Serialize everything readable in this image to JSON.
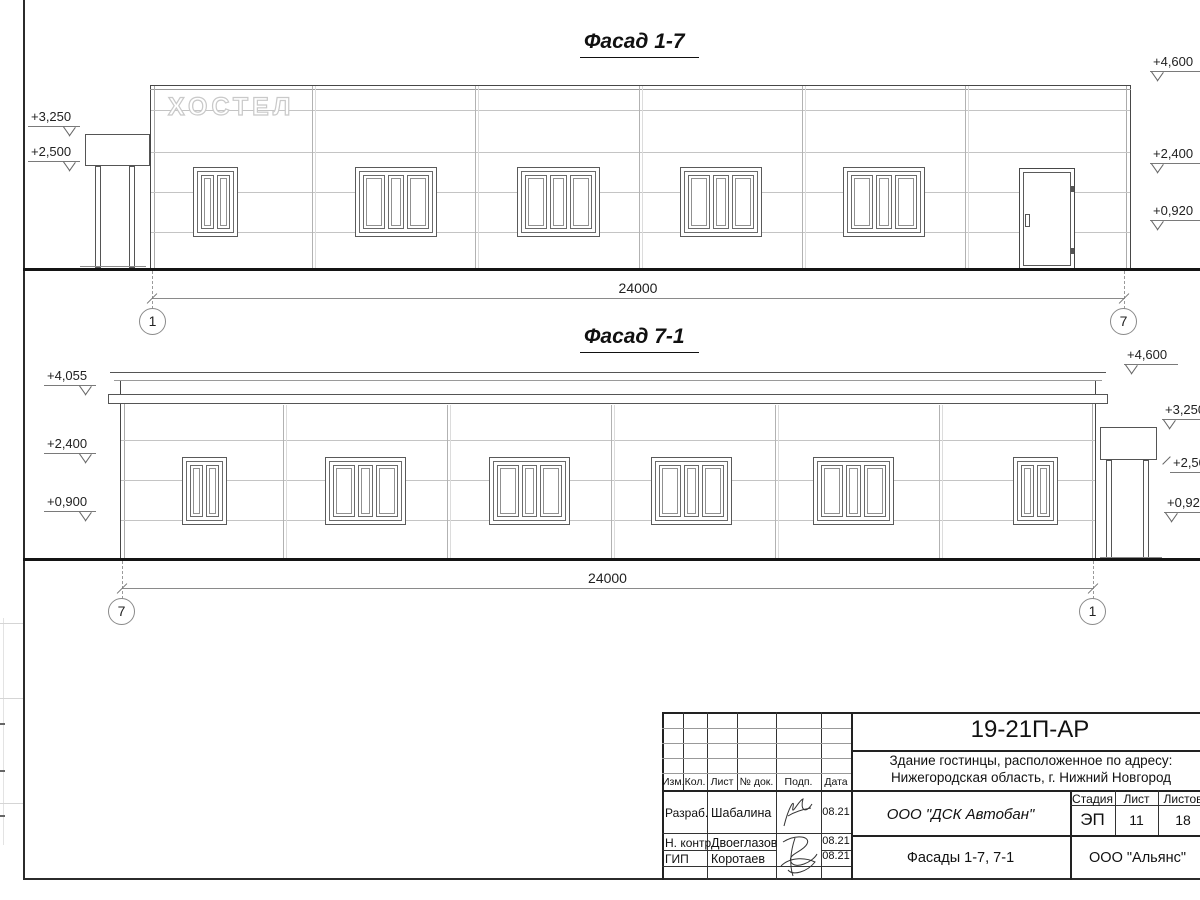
{
  "colors": {
    "ink": "#222222",
    "background": "#ffffff"
  },
  "facades": {
    "top": {
      "title": "Фасад 1-7",
      "sign": "ХОСТЕЛ",
      "dim": "24000",
      "axis_left": "1",
      "axis_right": "7",
      "marks_left": [
        "+3,250",
        "+2,500"
      ],
      "marks_right": [
        "+4,600",
        "+2,400",
        "+0,920"
      ]
    },
    "bottom": {
      "title": "Фасад 7-1",
      "dim": "24000",
      "axis_left": "7",
      "axis_right": "1",
      "marks_left": [
        "+4,055",
        "+2,400",
        "+0,900"
      ],
      "marks_right": [
        "+4,600",
        "+3,250",
        "+2,500",
        "+0,920"
      ]
    }
  },
  "titleblock": {
    "doc_number": "19-21П-АР",
    "object_line1": "Здание гостинцы, расположенное по адресу:",
    "object_line2": "Нижегородская область, г. Нижний Новгород",
    "header_cols": [
      "Изм.",
      "Кол.",
      "Лист",
      "№ док.",
      "Подп.",
      "Дата"
    ],
    "rows": [
      {
        "role": "Разраб.",
        "name": "Шабалина",
        "date": "08.21"
      },
      {
        "role": "Н. контр.",
        "name": "Двоеглазов",
        "date": "08.21"
      },
      {
        "role": "ГИП",
        "name": "Коротаев",
        "date": "08.21"
      }
    ],
    "contractor": "ООО \"ДСК Автобан\"",
    "stage_label": "Стадия",
    "sheet_label": "Лист",
    "sheets_label": "Листов",
    "stage_value": "ЭП",
    "sheet_value": "11",
    "sheets_value": "18",
    "drawing_title": "Фасады 1-7, 7-1",
    "organization": "ООО \"Альянс\""
  }
}
